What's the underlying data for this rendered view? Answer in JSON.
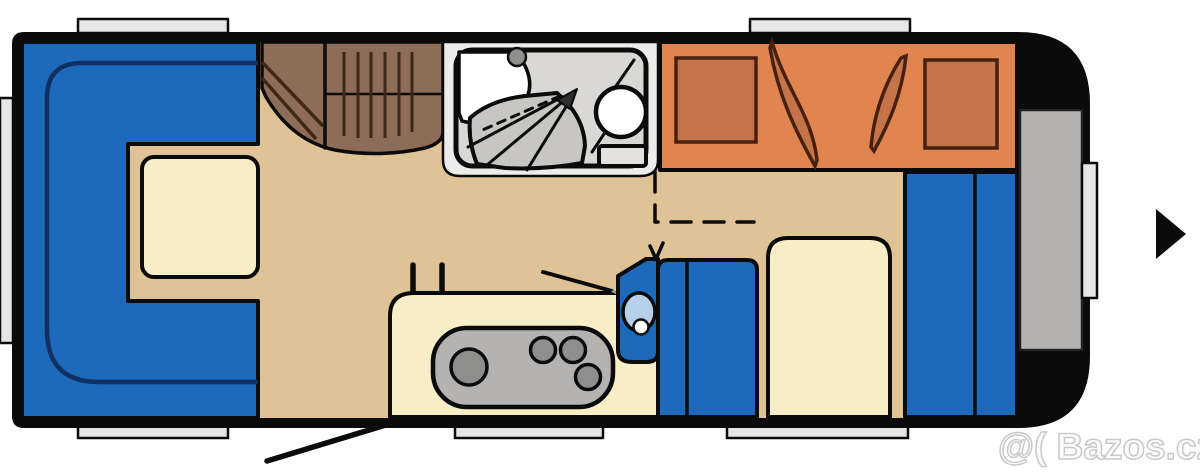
{
  "watermark": {
    "text": "@( Bazos.cz"
  },
  "gallery": {
    "next_arrow_shape": "right-pointing-triangle"
  },
  "floorplan": {
    "type": "caravan-floor-plan-top-view",
    "areas": [
      "u-shaped-dinette-with-table",
      "wardrobe-with-hangers",
      "bathroom-with-sink-shower-toilet",
      "transverse-bed-with-pillows",
      "kitchen-with-hob-sink-fridge",
      "single-bed",
      "rear-wardrobes",
      "entrance-door-swing",
      "windows"
    ]
  },
  "colors": {
    "ink": "#0b0b0b",
    "floor": "#dfc295",
    "cream": "#f7edc6",
    "blue": "#1d69bb",
    "navy": "#0f3060",
    "brown": "#8d6c59",
    "brownDark": "#3f2817",
    "orange": "#e0854f",
    "orangeDark": "#c5744a",
    "orangeLine": "#47200e",
    "grayLight": "#e6e6e6",
    "grayMid": "#b5b3b1",
    "grayBath": "#d9d8d5",
    "bathOuter": "#edecea",
    "tray": "#c7c6c3",
    "burner": "#8e8e8c",
    "basin": "#b7d0ea",
    "white": "#ffffff",
    "watermark": "#c9c9c9"
  }
}
